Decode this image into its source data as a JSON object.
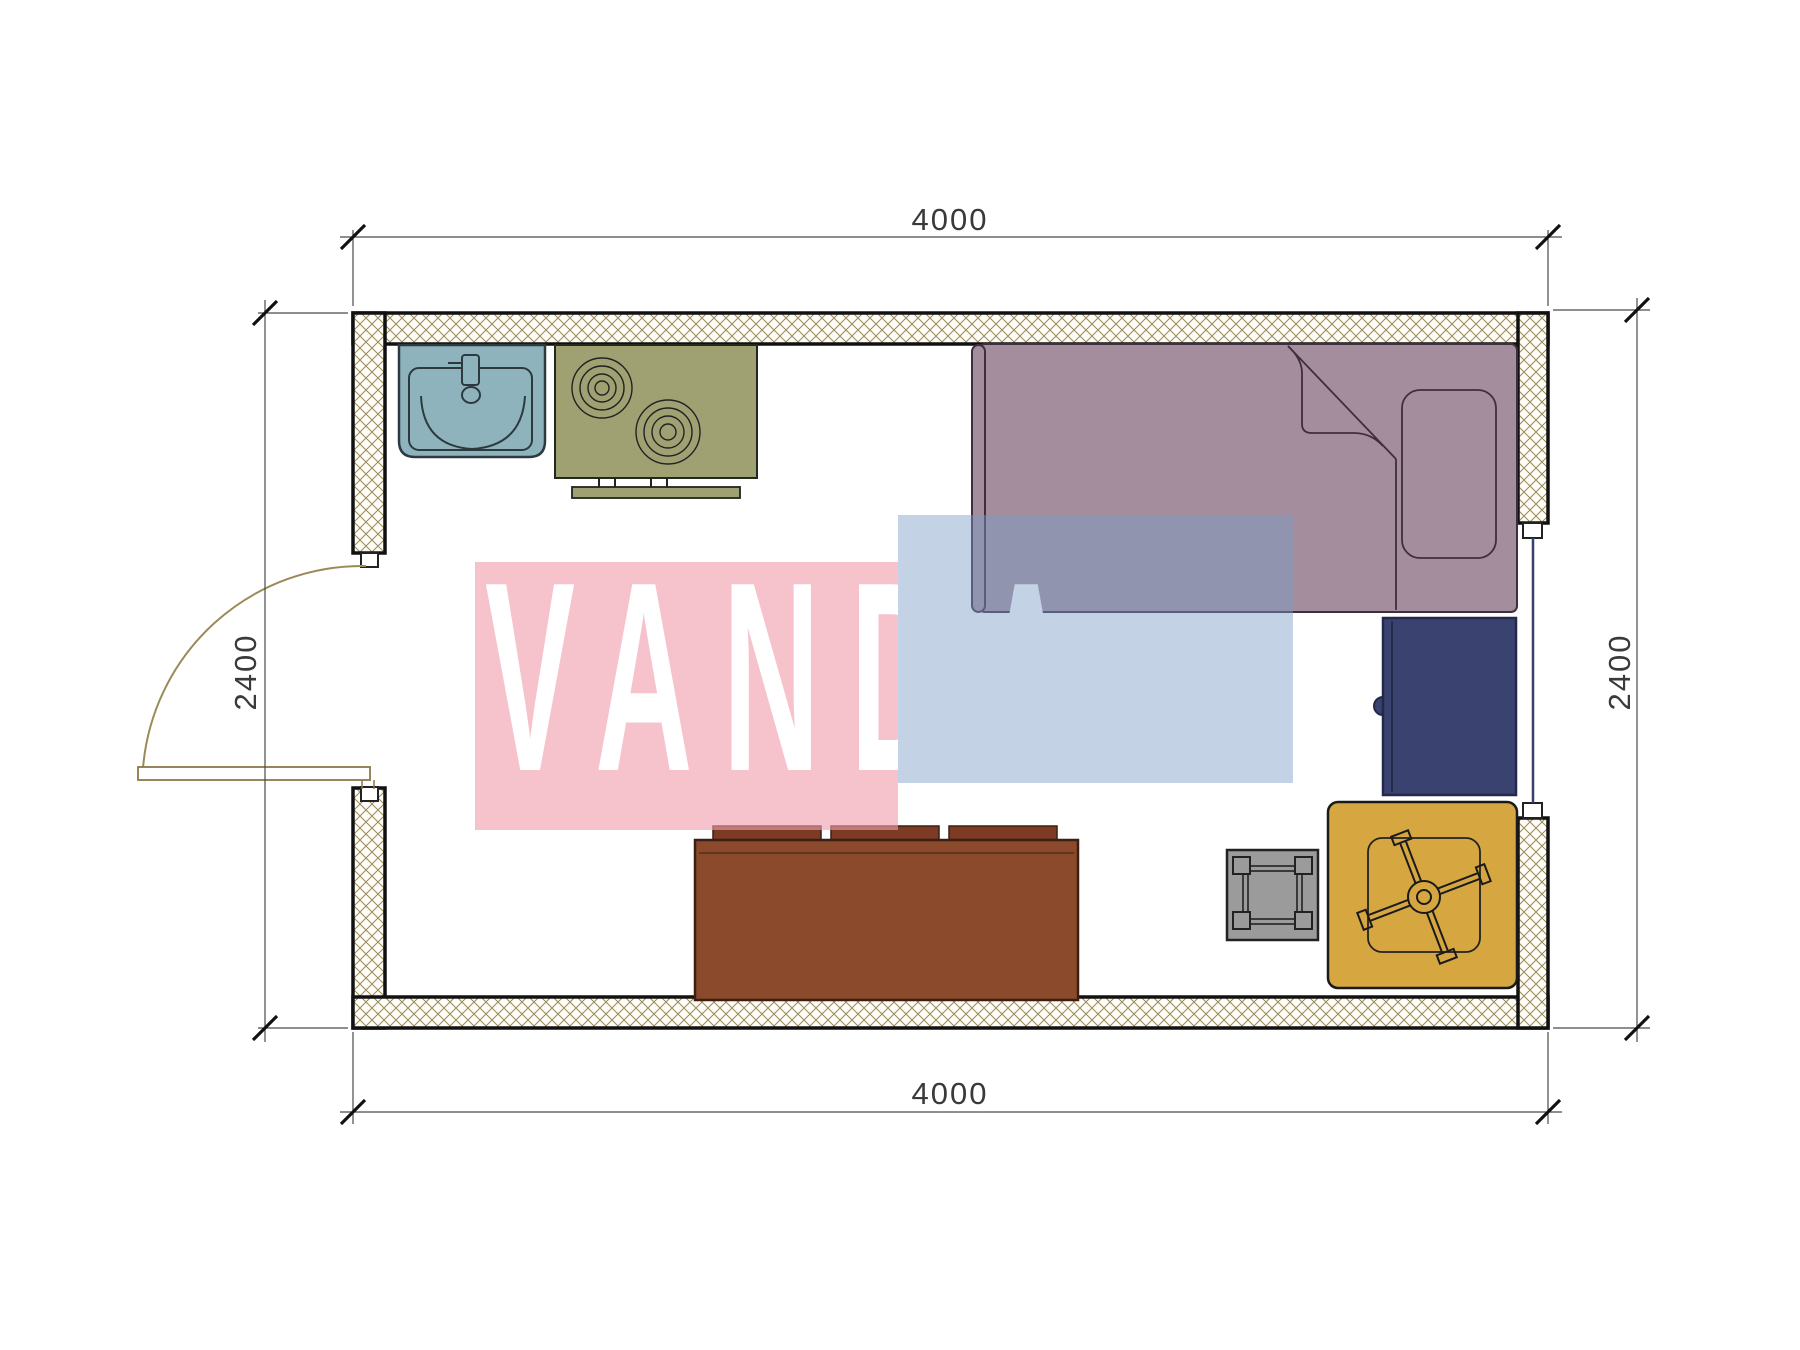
{
  "watermark": {
    "text": "VANDA",
    "pink_color": "rgba(240,158,172,0.62)",
    "blue_color": "rgba(122,155,195,0.45)",
    "text_color": "#ffffff"
  },
  "dimensions": {
    "top": "4000",
    "bottom": "4000",
    "left": "2400",
    "right": "2400"
  },
  "colors": {
    "wall_hatch": "#9b8a58",
    "wall_outline": "#111111",
    "sink": "#8fb3bc",
    "stove": "#a0a173",
    "bed": "#a48e9d",
    "cabinet": "#3a4270",
    "sofa": "#8b4a2b",
    "sofa_cushion": "#7d3b24",
    "stool": "#9b9b9b",
    "chair": "#d6a640",
    "window": "#35406e",
    "door": "#9b8a58"
  },
  "furniture": {
    "sink": "kitchen sink",
    "stove": "two-burner stove",
    "bed": "single bed with pillow",
    "cabinet": "bedside cabinet",
    "sofa": "sofa with three back cushions",
    "stool": "side table / stool",
    "chair": "swivel chair on mat",
    "door": "entry door (left wall)",
    "window": "window (right wall)"
  }
}
